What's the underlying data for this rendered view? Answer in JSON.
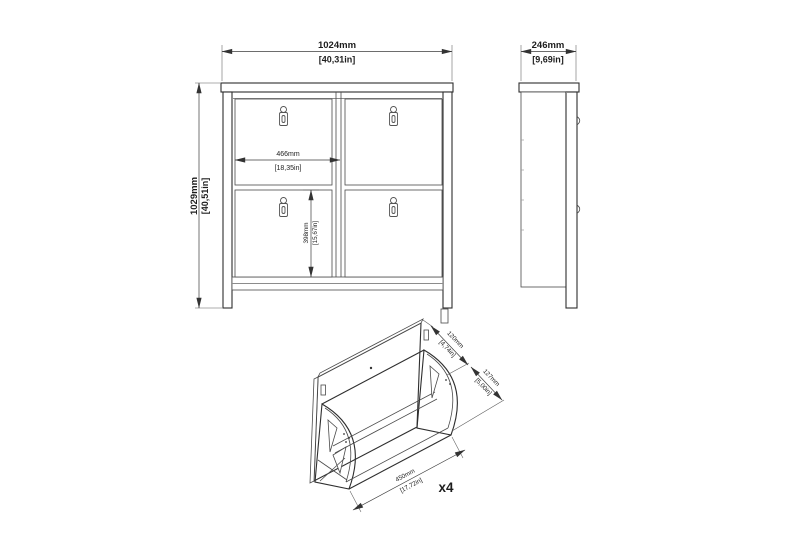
{
  "front_view": {
    "width_mm": "1024mm",
    "width_in": "[40,31in]",
    "height_mm": "1029mm",
    "height_in": "[40,51in]",
    "compartment_width_mm": "466mm",
    "compartment_width_in": "[18,35in]",
    "door_height_mm": "398mm",
    "door_height_in": "[15,67in]"
  },
  "side_view": {
    "depth_mm": "246mm",
    "depth_in": "[9,69in]"
  },
  "detail_view": {
    "top_gap_mm": "120mm",
    "top_gap_in": "[4,74in]",
    "opening_mm": "127mm",
    "opening_in": "[5,00in]",
    "width_mm": "450mm",
    "width_in": "[17,72in]",
    "quantity_label": "x4"
  },
  "colors": {
    "line": "#2e2e2e",
    "background": "#ffffff"
  }
}
